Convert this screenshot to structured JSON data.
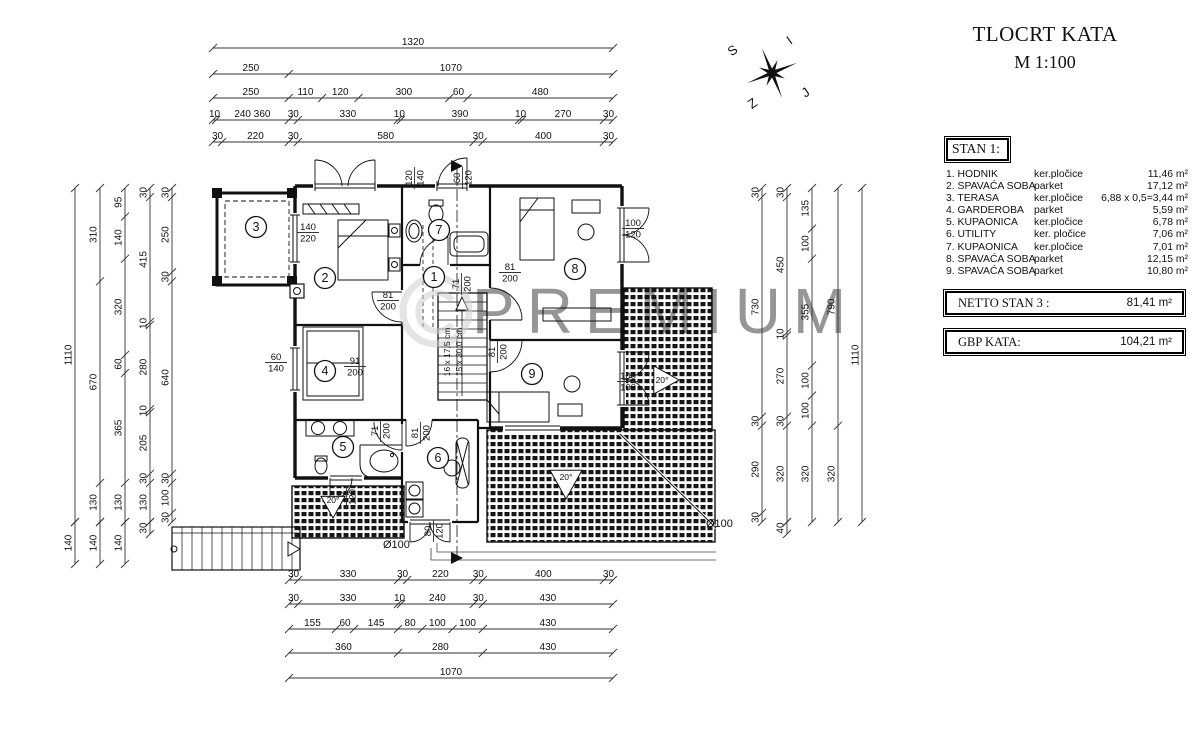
{
  "title": {
    "line1": "TLOCRT KATA",
    "line2": "M 1:100"
  },
  "watermark": "PREMIUM",
  "compass": {
    "letters": [
      "S",
      "I",
      "Z",
      "J"
    ]
  },
  "legend": {
    "header": "STAN 1:",
    "rows": [
      {
        "name": "1. HODNIK",
        "material": "ker.pločice",
        "area": "11,46 m²"
      },
      {
        "name": "2. SPAVAĆA SOBA",
        "material": "parket",
        "area": "17,12 m²"
      },
      {
        "name": "3. TERASA",
        "material": "ker.pločice",
        "area": "6,88 x 0,5=3,44 m²"
      },
      {
        "name": "4. GARDEROBA",
        "material": "parket",
        "area": "5,59 m²"
      },
      {
        "name": "5. KUPAONICA",
        "material": "ker.pločice",
        "area": "6,78 m²"
      },
      {
        "name": "6. UTILITY",
        "material": "ker. pločice",
        "area": "7,06 m²"
      },
      {
        "name": "7. KUPAONICA",
        "material": "ker.pločice",
        "area": "7,01 m²"
      },
      {
        "name": "8. SPAVAĆA SOBA",
        "material": "parket",
        "area": "12,15 m²"
      },
      {
        "name": "9. SPAVAĆA SOBA",
        "material": "parket",
        "area": "10,80 m²"
      }
    ]
  },
  "totals": [
    {
      "label": "NETTO STAN 3 :",
      "value": "81,41  m²"
    },
    {
      "label": "GBP  KATA:",
      "value": "104,21  m²"
    }
  ],
  "plan": {
    "rooms": [
      {
        "n": "1",
        "x": 434,
        "y": 277
      },
      {
        "n": "2",
        "x": 325,
        "y": 278
      },
      {
        "n": "3",
        "x": 256,
        "y": 227
      },
      {
        "n": "4",
        "x": 325,
        "y": 371
      },
      {
        "n": "5",
        "x": 343,
        "y": 447
      },
      {
        "n": "6",
        "x": 438,
        "y": 458
      },
      {
        "n": "7",
        "x": 439,
        "y": 230
      },
      {
        "n": "8",
        "x": 575,
        "y": 269
      },
      {
        "n": "9",
        "x": 532,
        "y": 374
      }
    ],
    "stairs_label": [
      "16 x 17,5 cm",
      "15 x 30,0 cm"
    ],
    "openings": [
      {
        "a": "120",
        "b": "140",
        "x": 414,
        "y": 178,
        "rot": 1
      },
      {
        "a": "60",
        "b": "120",
        "x": 462,
        "y": 178,
        "rot": 1
      },
      {
        "a": "140",
        "b": "220",
        "x": 308,
        "y": 232,
        "rot": 0
      },
      {
        "a": "71",
        "b": "200",
        "x": 461,
        "y": 284,
        "rot": 1
      },
      {
        "a": "81",
        "b": "200",
        "x": 388,
        "y": 300,
        "rot": 0
      },
      {
        "a": "81",
        "b": "200",
        "x": 510,
        "y": 272,
        "rot": 0
      },
      {
        "a": "81",
        "b": "200",
        "x": 497,
        "y": 352,
        "rot": 1
      },
      {
        "a": "91",
        "b": "200",
        "x": 355,
        "y": 366,
        "rot": 0
      },
      {
        "a": "60",
        "b": "140",
        "x": 276,
        "y": 362,
        "rot": 0
      },
      {
        "a": "71",
        "b": "200",
        "x": 380,
        "y": 431,
        "rot": 1
      },
      {
        "a": "81",
        "b": "200",
        "x": 420,
        "y": 433,
        "rot": 1
      },
      {
        "a": "100",
        "b": "120",
        "x": 633,
        "y": 228,
        "rot": 0
      },
      {
        "a": "100",
        "b": "100",
        "x": 628,
        "y": 381,
        "rot": 0
      },
      {
        "a": "80",
        "b": "120",
        "x": 346,
        "y": 497,
        "rot": 1
      },
      {
        "a": "80",
        "b": "120",
        "x": 433,
        "y": 531,
        "rot": 1
      }
    ],
    "annotations": [
      {
        "text": "20°",
        "x": 566,
        "y": 483,
        "tri": "down",
        "s": 16
      },
      {
        "text": "20°",
        "x": 333,
        "y": 506,
        "tri": "down",
        "s": 12
      },
      {
        "text": "20°",
        "x": 665,
        "y": 380,
        "tri": "right",
        "s": 14
      },
      {
        "text": "Ø100",
        "x": 706,
        "y": 527
      },
      {
        "text": "Ø100",
        "x": 383,
        "y": 548
      }
    ]
  },
  "dimensions": {
    "h": [
      {
        "y": 48,
        "x1": 213,
        "x2": 613,
        "v": [
          "1320"
        ]
      },
      {
        "y": 74,
        "x1": 213,
        "x2": 613,
        "v": [
          "250",
          "1070"
        ]
      },
      {
        "y": 98,
        "x1": 213,
        "x2": 613,
        "v": [
          "250",
          "110",
          "120",
          "300",
          "60",
          "480"
        ]
      },
      {
        "y": 120,
        "x1": 213,
        "x2": 613,
        "v": [
          "10",
          "240 360",
          "30",
          "330",
          "10",
          "390",
          "10",
          "270",
          "30"
        ],
        "w": [
          10,
          240,
          30,
          330,
          10,
          390,
          10,
          270,
          30
        ]
      },
      {
        "y": 142,
        "x1": 213,
        "x2": 613,
        "v": [
          "30",
          "220",
          "30",
          "580",
          "30",
          "400",
          "30"
        ]
      },
      {
        "y": 580,
        "x1": 289,
        "x2": 613,
        "v": [
          "30",
          "330",
          "30",
          "220",
          "30",
          "400",
          "30"
        ]
      },
      {
        "y": 604,
        "x1": 289,
        "x2": 613,
        "v": [
          "30",
          "330",
          "10",
          "240",
          "30",
          "430"
        ]
      },
      {
        "y": 629,
        "x1": 289,
        "x2": 613,
        "v": [
          "155",
          "60",
          "145",
          "80",
          "100",
          "100",
          "430"
        ]
      },
      {
        "y": 653,
        "x1": 289,
        "x2": 613,
        "v": [
          "360",
          "280",
          "430"
        ]
      },
      {
        "y": 678,
        "x1": 289,
        "x2": 613,
        "v": [
          "1070"
        ]
      }
    ],
    "v": [
      {
        "x": 75,
        "y1": 188,
        "y2": 522,
        "v": [
          "1110"
        ]
      },
      {
        "x": 75,
        "y1": 522,
        "y2": 564,
        "v": [
          "140"
        ]
      },
      {
        "x": 100,
        "y1": 188,
        "y2": 522,
        "v": [
          "310",
          "670",
          "130"
        ]
      },
      {
        "x": 100,
        "y1": 522,
        "y2": 564,
        "v": [
          "140"
        ]
      },
      {
        "x": 125,
        "y1": 188,
        "y2": 522,
        "v": [
          "95",
          "140",
          "320",
          "60",
          "365",
          "130"
        ]
      },
      {
        "x": 125,
        "y1": 522,
        "y2": 564,
        "v": [
          "140"
        ]
      },
      {
        "x": 150,
        "y1": 188,
        "y2": 522,
        "v": [
          "30",
          "415",
          "10",
          "280",
          "10",
          "205",
          "30",
          "130"
        ]
      },
      {
        "x": 150,
        "y1": 522,
        "y2": 534,
        "v": [
          "30"
        ]
      },
      {
        "x": 172,
        "y1": 188,
        "y2": 522,
        "v": [
          "30",
          "250",
          "30",
          "640",
          "30",
          "100",
          "30"
        ]
      },
      {
        "x": 762,
        "y1": 188,
        "y2": 522,
        "v": [
          "30",
          "730",
          "30",
          "290",
          "30"
        ]
      },
      {
        "x": 787,
        "y1": 188,
        "y2": 522,
        "v": [
          "30",
          "450",
          "10",
          "270",
          "30",
          "320"
        ]
      },
      {
        "x": 787,
        "y1": 522,
        "y2": 534,
        "v": [
          "40"
        ]
      },
      {
        "x": 812,
        "y1": 188,
        "y2": 522,
        "v": [
          "135",
          "100",
          "355",
          "100",
          "100",
          "320"
        ]
      },
      {
        "x": 838,
        "y1": 188,
        "y2": 522,
        "v": [
          "790",
          "320"
        ]
      },
      {
        "x": 862,
        "y1": 188,
        "y2": 522,
        "v": [
          "1110"
        ]
      }
    ]
  }
}
